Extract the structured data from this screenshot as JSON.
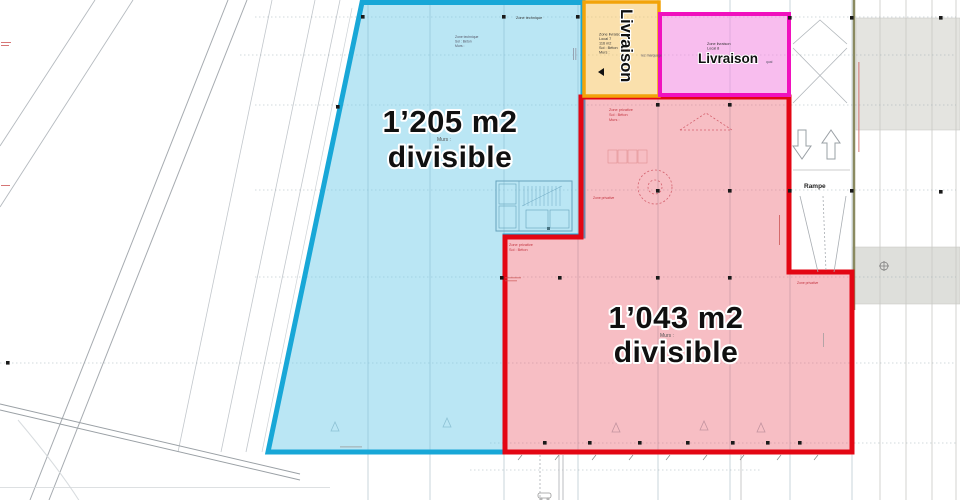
{
  "zones": {
    "blue": {
      "area": "1’205 m2",
      "divisible": "divisible",
      "murs_note": "Murs :"
    },
    "red": {
      "area": "1’043 m2",
      "divisible": "divisible",
      "murs_note": "Murs :"
    },
    "delivery_yellow": {
      "title": "Livraison",
      "line1": "Zone livraison",
      "line2": "Local 7",
      "line3": "116 m2",
      "line4": "Sol : Béton",
      "line5": "Murs :",
      "side_note": "rez marquage"
    },
    "delivery_magenta": {
      "title": "Livraison",
      "line1": "Zone livraison",
      "line2": "Local 8",
      "side_note": "quai"
    }
  },
  "ramp": {
    "label": "Rampe"
  },
  "notes": {
    "technical": "Zone technique",
    "private_zone": "Zone privative",
    "floor": "Sol : Béton",
    "walls": "Murs :"
  },
  "colors": {
    "blue_border": "#18a7d7",
    "blue_fill": "#c7e8f4",
    "red_border": "#e30613",
    "red_fill": "#f6c3cb",
    "yellow_border": "#f2a30a",
    "yellow_fill": "#f8e3ae",
    "magenta_border": "#f011be",
    "magenta_fill": "#f4a7e3"
  }
}
